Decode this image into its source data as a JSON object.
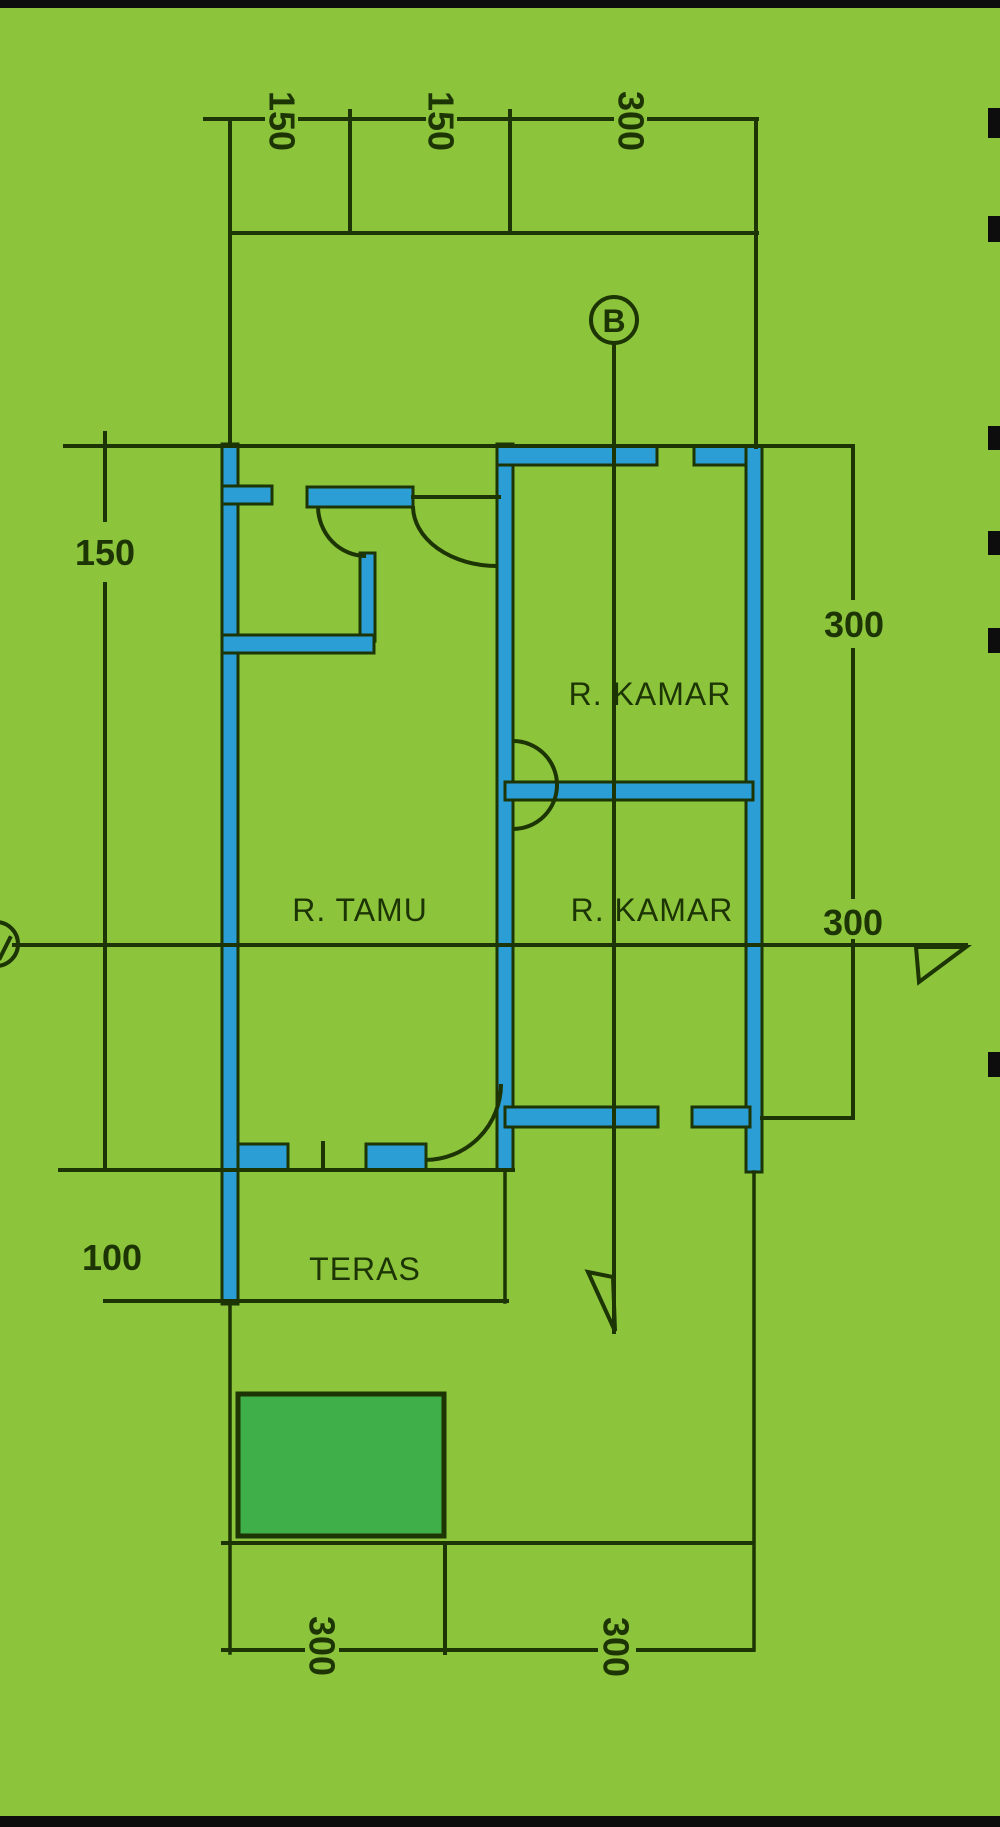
{
  "title": "house-floor-plan-sketch",
  "colors": {
    "background": "#8cc53c",
    "wall_fill": "#2b9ed6",
    "line": "#1d3404",
    "garden_rect": "#3fb049",
    "edge_black": "#0d0d0d"
  },
  "rooms": {
    "kamar_top": "R. KAMAR",
    "kamar_bottom": "R. KAMAR",
    "tamu": "R. TAMU",
    "teras": "TERAS"
  },
  "section_marker": {
    "label": "B"
  },
  "dimensions": {
    "top": [
      "150",
      "150",
      "300"
    ],
    "left": {
      "upper": "150",
      "lower": "100"
    },
    "right": {
      "upper": "300",
      "lower": "300"
    },
    "bottom": [
      "300",
      "300"
    ]
  }
}
